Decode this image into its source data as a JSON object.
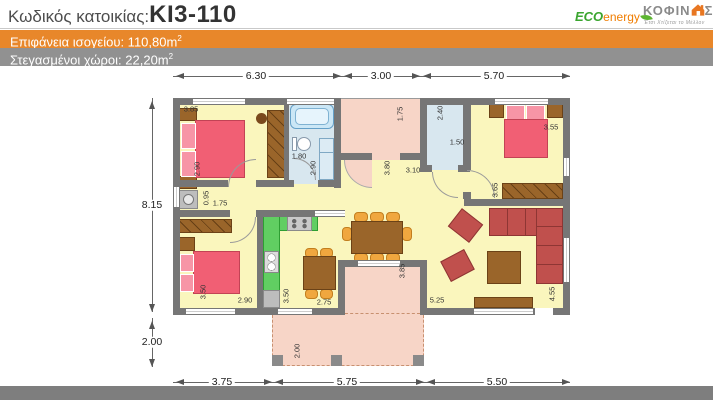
{
  "header": {
    "code_label": "Κωδικός κατοικίας:",
    "code_value": "ΚΙ3-110",
    "eco_logo": {
      "eco": "ECO",
      "energy": "energy"
    },
    "kofinas_logo": {
      "name_prefix": "ΚΟΦΙΝ",
      "name_suffix": "Σ",
      "tagline": "Έτσι Χτίζεται το Μέλλον"
    }
  },
  "banners": [
    {
      "text": "Επιφάνεια ισογείου: 110,80m",
      "sup": "2",
      "bg": "#E8872A"
    },
    {
      "text": "Στεγασμένοι χώροι: 22,20m",
      "sup": "2",
      "bg": "#919191"
    }
  ],
  "colors": {
    "banner_orange": "#E8872A",
    "banner_gray": "#919191",
    "bottom_bar": "#7E7E7E",
    "wall": "#767676",
    "room_yellow": "#FAF6BD",
    "patio_pink": "#F7D5C7",
    "bathroom_blue": "#D8E7EF",
    "kitchen_green": "#61CE62",
    "bed_red": "#F15F74",
    "sofa_red": "#C0504D",
    "wood_brown": "#9A652A",
    "chair_orange": "#F0A73F",
    "eco_green": "#3AA52F",
    "energy_orange": "#F07D00",
    "kofinas_gray": "#8A8A8A",
    "house_orange": "#E87722"
  },
  "plan": {
    "dimension_labels": [
      {
        "t": "6.30",
        "x": 256,
        "y": 76,
        "o": "h",
        "s": "main"
      },
      {
        "t": "3.00",
        "x": 381,
        "y": 76,
        "o": "h",
        "s": "main"
      },
      {
        "t": "5.70",
        "x": 494,
        "y": 76,
        "o": "h",
        "s": "main"
      },
      {
        "t": "8.15",
        "x": 152,
        "y": 205,
        "o": "h",
        "s": "main"
      },
      {
        "t": "2.00",
        "x": 152,
        "y": 342,
        "o": "h",
        "s": "main"
      },
      {
        "t": "3.75",
        "x": 222,
        "y": 382,
        "o": "h",
        "s": "main"
      },
      {
        "t": "5.75",
        "x": 347,
        "y": 382,
        "o": "h",
        "s": "main"
      },
      {
        "t": "5.50",
        "x": 497,
        "y": 382,
        "o": "h",
        "s": "main"
      },
      {
        "t": "3.85",
        "x": 191,
        "y": 109,
        "o": "h",
        "s": "small"
      },
      {
        "t": "2.90",
        "x": 197,
        "y": 169,
        "o": "v",
        "s": "small"
      },
      {
        "t": "1.80",
        "x": 299,
        "y": 156,
        "o": "h",
        "s": "small"
      },
      {
        "t": "2.90",
        "x": 313,
        "y": 168,
        "o": "v",
        "s": "small"
      },
      {
        "t": "0.95",
        "x": 206,
        "y": 198,
        "o": "v",
        "s": "small"
      },
      {
        "t": "1.75",
        "x": 220,
        "y": 203,
        "o": "h",
        "s": "small"
      },
      {
        "t": "3.50",
        "x": 203,
        "y": 292,
        "o": "v",
        "s": "small"
      },
      {
        "t": "2.90",
        "x": 245,
        "y": 300,
        "o": "h",
        "s": "small"
      },
      {
        "t": "3.50",
        "x": 286,
        "y": 296,
        "o": "v",
        "s": "small"
      },
      {
        "t": "2.75",
        "x": 324,
        "y": 302,
        "o": "h",
        "s": "small"
      },
      {
        "t": "1.75",
        "x": 400,
        "y": 114,
        "o": "v",
        "s": "small"
      },
      {
        "t": "3.80",
        "x": 387,
        "y": 168,
        "o": "v",
        "s": "small"
      },
      {
        "t": "3.10",
        "x": 413,
        "y": 170,
        "o": "h",
        "s": "small"
      },
      {
        "t": "2.40",
        "x": 440,
        "y": 113,
        "o": "v",
        "s": "small"
      },
      {
        "t": "1.50",
        "x": 457,
        "y": 142,
        "o": "h",
        "s": "small"
      },
      {
        "t": "3.55",
        "x": 551,
        "y": 127,
        "o": "h",
        "s": "small"
      },
      {
        "t": "3.65",
        "x": 495,
        "y": 190,
        "o": "v",
        "s": "small"
      },
      {
        "t": "3.85",
        "x": 402,
        "y": 271,
        "o": "v",
        "s": "small"
      },
      {
        "t": "5.25",
        "x": 437,
        "y": 300,
        "o": "h",
        "s": "small"
      },
      {
        "t": "4.55",
        "x": 552,
        "y": 294,
        "o": "v",
        "s": "small"
      },
      {
        "t": "2.00",
        "x": 297,
        "y": 351,
        "o": "v",
        "s": "small"
      }
    ]
  }
}
